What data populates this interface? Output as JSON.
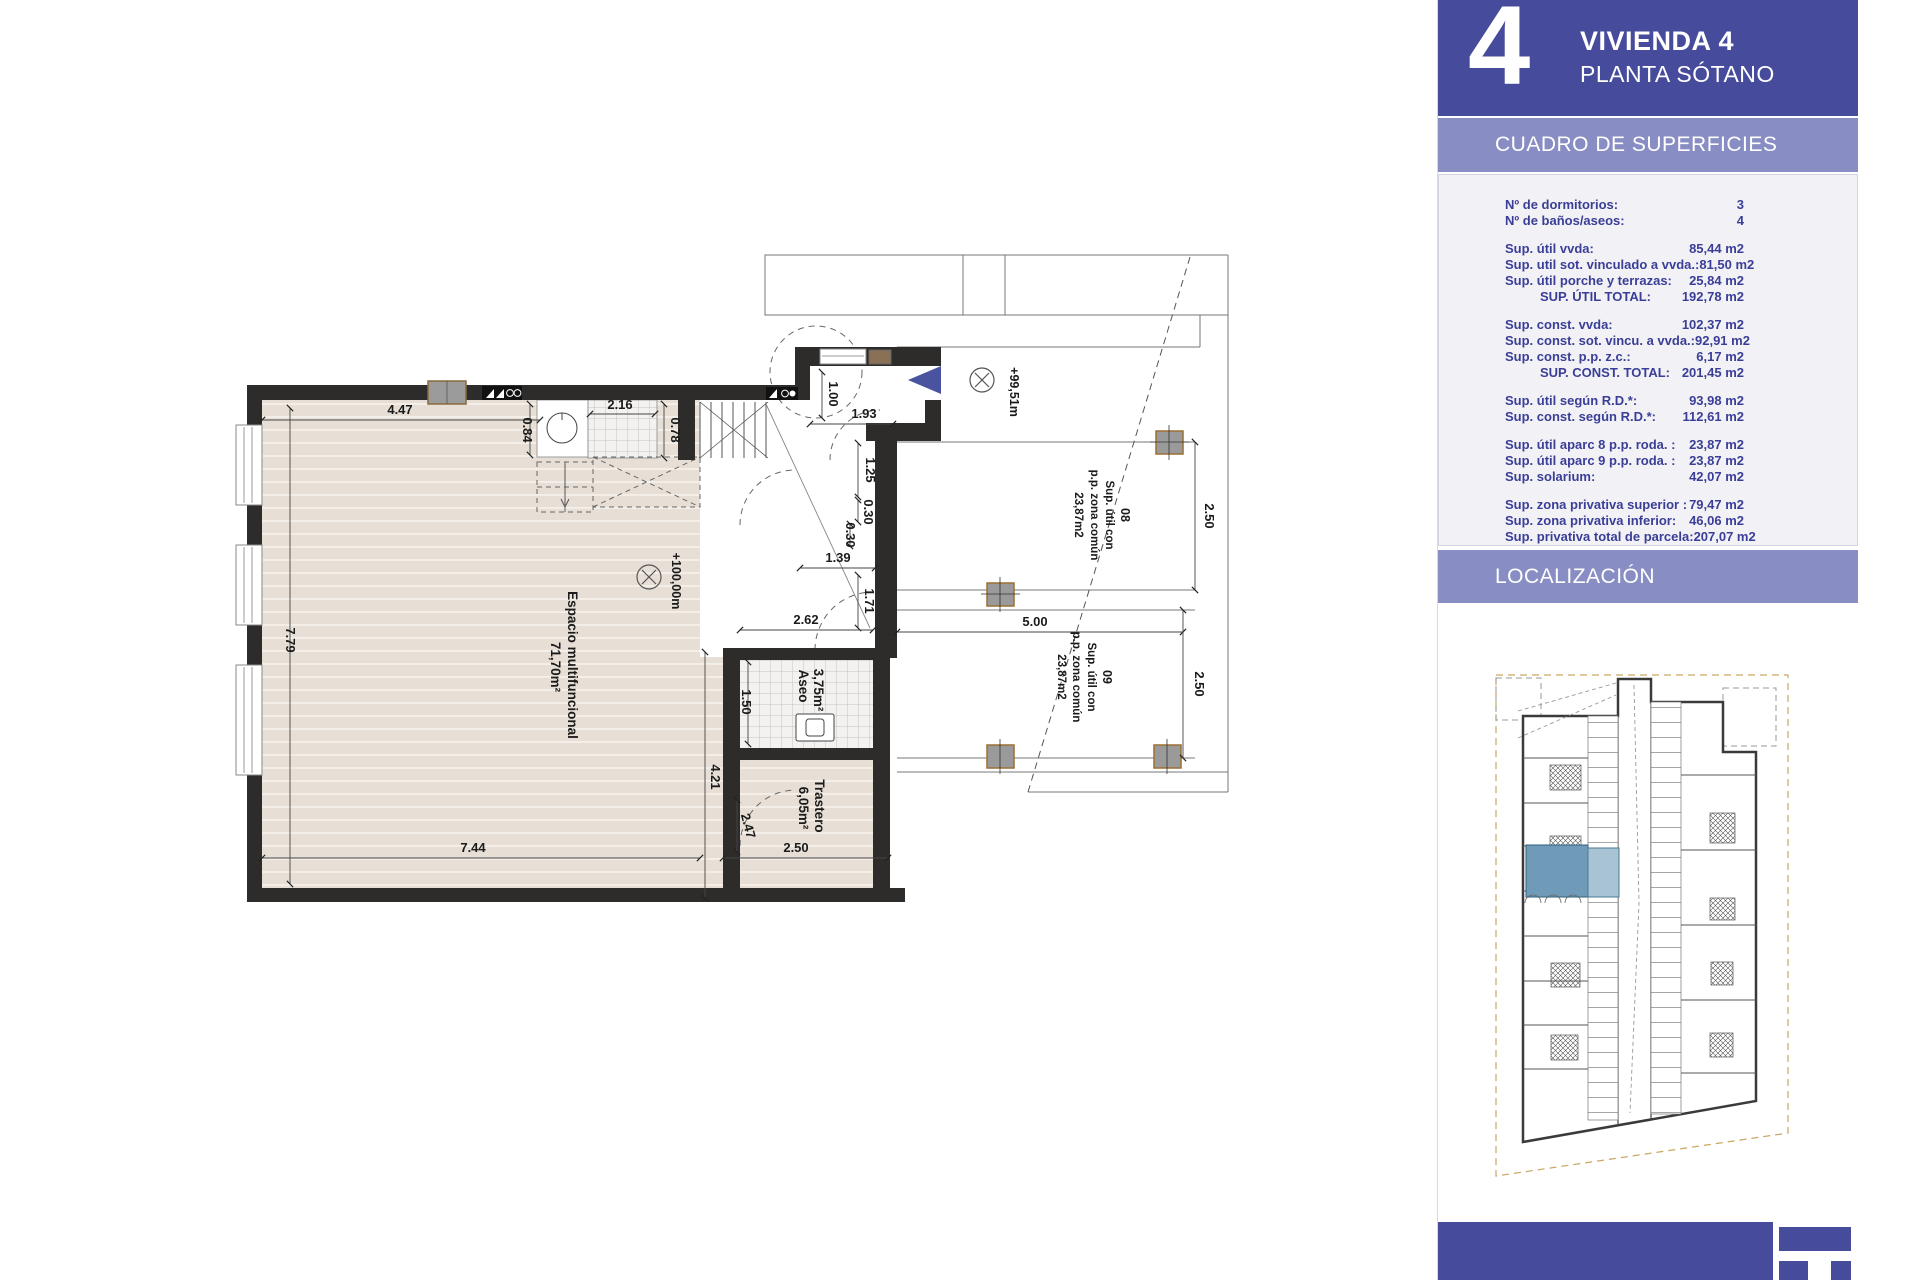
{
  "header": {
    "number": "4",
    "title": "VIVIENDA 4",
    "subtitle": "PLANTA SÓTANO"
  },
  "sections": {
    "surfaces": "CUADRO DE SUPERFICIES",
    "location": "LOCALIZACIÓN"
  },
  "table": {
    "counts": [
      {
        "l": "Nº de dormitorios:",
        "v": "3"
      },
      {
        "l": "Nº de baños/aseos:",
        "v": "4"
      }
    ],
    "g1": [
      {
        "l": "Sup. útil vvda:",
        "v": "85,44 m2"
      },
      {
        "l": "Sup. util sot. vinculado a vvda.:",
        "v": "81,50 m2"
      },
      {
        "l": "Sup. útil porche y terrazas:",
        "v": "25,84 m2"
      },
      {
        "l": "SUP. ÚTIL TOTAL:",
        "v": "192,78 m2"
      }
    ],
    "g2": [
      {
        "l": "Sup. const. vvda:",
        "v": "102,37 m2"
      },
      {
        "l": "Sup. const. sot. vincu. a vvda.:",
        "v": "92,91 m2"
      },
      {
        "l": "Sup. const. p.p. z.c.:",
        "v": "6,17 m2"
      },
      {
        "l": "SUP. CONST. TOTAL:",
        "v": "201,45 m2"
      }
    ],
    "g3": [
      {
        "l": "Sup. útil según R.D.*:",
        "v": "93,98 m2"
      },
      {
        "l": "Sup. const. según R.D.*:",
        "v": "112,61 m2"
      }
    ],
    "g4": [
      {
        "l": "Sup. útil aparc 8 p.p. roda. :",
        "v": "23,87 m2"
      },
      {
        "l": "Sup. útil aparc 9 p.p. roda. :",
        "v": "23,87 m2"
      },
      {
        "l": "Sup. solarium:",
        "v": "42,07 m2"
      }
    ],
    "g5": [
      {
        "l": "Sup. zona privativa superior :",
        "v": "79,47 m2"
      },
      {
        "l": "Sup. zona privativa inferior:",
        "v": "46,06 m2"
      },
      {
        "l": "Sup. privativa total de parcela:",
        "v": "207,07 m2"
      }
    ]
  },
  "plan": {
    "rooms": {
      "main_name": "Espacio multifuncional",
      "main_area": "71,70m²",
      "aseo_name": "Aseo",
      "aseo_area": "3,75m²",
      "trastero_name": "Trastero",
      "trastero_area": "6,05m²"
    },
    "levels": {
      "main": "+100,00m",
      "entry": "+99,51m"
    },
    "parking": [
      {
        "num": "08",
        "l1": "Sup. útil con",
        "l2": "p.p. zona común",
        "area": "23,87m2"
      },
      {
        "num": "09",
        "l1": "Sup. útil con",
        "l2": "p.p. zona común",
        "area": "23,87m2"
      }
    ],
    "dims": {
      "top_w": "4.47",
      "d084": "0.84",
      "d216": "2.16",
      "d078": "0.78",
      "d100": "1.00",
      "d193": "1.93",
      "d125": "1.25",
      "d030a": "0.30",
      "d030b": "0.30",
      "d139": "1.39",
      "d171": "1.71",
      "d262": "2.62",
      "d500": "5.00",
      "d150": "1.50",
      "d421": "4.21",
      "d247": "2.47",
      "d250a": "2.50",
      "d250b": "2.50",
      "d250c": "2.50",
      "left_h": "7.79",
      "bottom_w": "7.44"
    }
  },
  "colors": {
    "brand_blue": "#474b9b",
    "band_purple": "#888dc4",
    "table_navy": "#3a3e96",
    "floor_beige": "#e7dfd6",
    "wall_dark": "#2e2c2a",
    "highlight_blue": "#6f9bb8",
    "boundary_gold": "#c9a863",
    "entrance_arrow_blue": "#4a53a0"
  }
}
